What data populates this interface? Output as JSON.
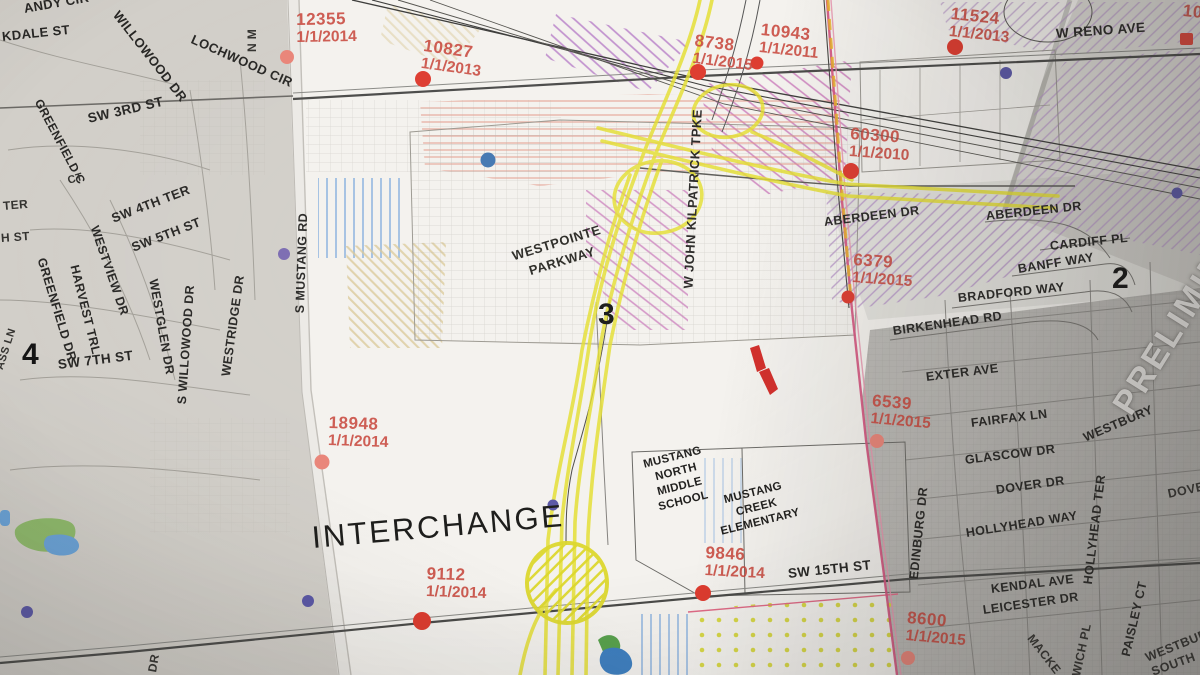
{
  "map_photo": {
    "type": "paper planning map photo",
    "watermark": "PRELIMIN",
    "interchange_label": "INTERCHANGE",
    "region_numbers": {
      "left_sheet": "4",
      "center_sheet": "3",
      "right_sheet": "2"
    }
  },
  "colors": {
    "annotation_red": "#c8463c",
    "highlight_yellow": "#e4de2e",
    "section_line_pink": "#d4517c",
    "dot_red": "#dd3a2e",
    "dot_salmon": "#e98478",
    "dot_blue": "#3f74b0",
    "dot_purple": "#5a57a6",
    "pond_green": "#6fae54",
    "pond_blue": "#4784c2"
  },
  "places": {
    "westpointe": [
      "WESTPOINTE",
      "PARKWAY"
    ],
    "mustang_north": [
      "MUSTANG",
      "NORTH",
      "MIDDLE",
      "SCHOOL"
    ],
    "mustang_creek": [
      "MUSTANG",
      "CREEK",
      "ELEMENTARY"
    ]
  },
  "streets": {
    "left": [
      "ANDY CIR",
      "KDALE ST",
      "WILLOWOOD DR",
      "LOCHWOOD CIR",
      "N M",
      "SW 3RD ST",
      "GREENFIELD C",
      "TER",
      "H ST",
      "CT",
      "SW 4TH TER",
      "SW 5TH ST",
      "WESTVIEW DR",
      "GREENFIELD DR",
      "HARVEST TRL",
      "WESTGLEN DR",
      "S WILLOWOOD DR",
      "WESTRIDGE DR",
      "SW 7TH ST",
      "ASS LN",
      "DR"
    ],
    "center": [
      "S MUSTANG RD",
      "W JOHN KILPATRICK TPKE",
      "SW 15TH ST"
    ],
    "right": [
      "W RENO AVE",
      "ABERDEEN DR",
      "ABERDEEN DR",
      "CARDIFF PL",
      "BANFF WAY",
      "BRADFORD WAY",
      "BIRKENHEAD RD",
      "EXTER AVE",
      "FAIRFAX LN",
      "WESTBURY",
      "GLASCOW DR",
      "DOVER DR",
      "DOVER",
      "HOLLYHEAD TER",
      "HOLLYHEAD WAY",
      "EDINBURG DR",
      "KENDAL AVE",
      "LEICESTER DR",
      "MACKE",
      "WICH PL",
      "PAISLEY CT",
      "WESTBUR",
      "SOUTH"
    ]
  },
  "annotations": [
    {
      "value": "12355",
      "date": "1/1/2014"
    },
    {
      "value": "10827",
      "date": "1/1/2013"
    },
    {
      "value": "8738",
      "date": "1/1/2015"
    },
    {
      "value": "10943",
      "date": "1/1/2011"
    },
    {
      "value": "11524",
      "date": "1/1/2013"
    },
    {
      "value": "60300",
      "date": "1/1/2010"
    },
    {
      "value": "6379",
      "date": "1/1/2015"
    },
    {
      "value": "18948",
      "date": "1/1/2014"
    },
    {
      "value": "9112",
      "date": "1/1/2014"
    },
    {
      "value": "9846",
      "date": "1/1/2014"
    },
    {
      "value": "6539",
      "date": "1/1/2015"
    },
    {
      "value": "8600",
      "date": "1/1/2015"
    },
    {
      "value": "10",
      "date": ""
    }
  ]
}
